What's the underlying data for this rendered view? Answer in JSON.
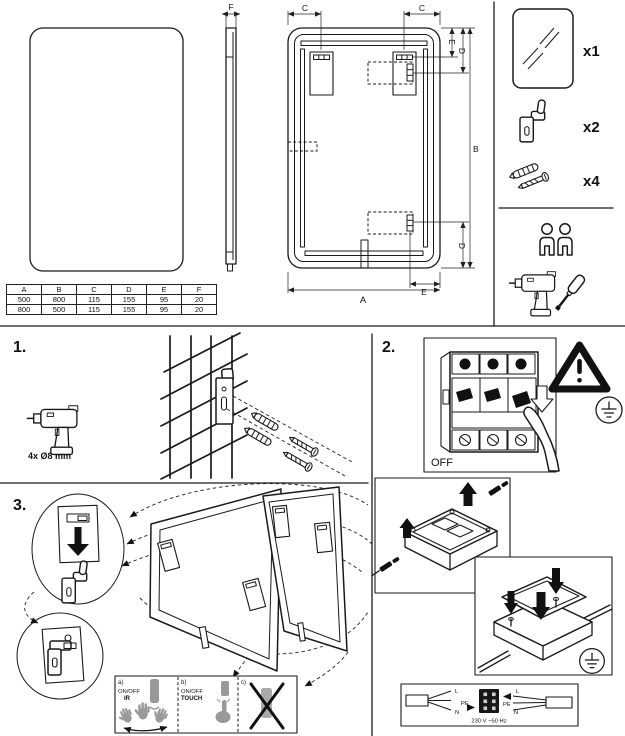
{
  "document": {
    "type": "mirror-installation-manual"
  },
  "colors": {
    "line": "#1a1a1a",
    "dim_line": "#222222",
    "icon_gray": "#999999",
    "background": "#ffffff"
  },
  "dimension_labels": {
    "a": "A",
    "b": "B",
    "c": "C",
    "d": "D",
    "e": "E",
    "f": "F"
  },
  "dimension_table": {
    "headers": [
      "A",
      "B",
      "C",
      "D",
      "E",
      "F"
    ],
    "rows": [
      [
        "500",
        "800",
        "115",
        "155",
        "95",
        "20"
      ],
      [
        "800",
        "500",
        "115",
        "155",
        "95",
        "20"
      ]
    ]
  },
  "parts": {
    "mirror_qty": "x1",
    "bracket_qty": "x2",
    "fastener_qty": "x4"
  },
  "icons": {
    "crew": "two-person-icon",
    "tools": "drill-and-screwdriver-icon",
    "warning": "warning-triangle-icon",
    "earth": "protective-earth-icon"
  },
  "step1": {
    "number": "1.",
    "drill_size_label": "4x Ø8 mm"
  },
  "step2": {
    "number": "2.",
    "breaker_state": "OFF",
    "power_rating": "230 V ~50 Hz",
    "wiring": {
      "left": {
        "l": "L",
        "pe": "PE",
        "n": "N"
      },
      "right": {
        "l": "L",
        "pe": "PE",
        "n": "N"
      }
    }
  },
  "step3": {
    "number": "3.",
    "options": {
      "a": {
        "key": "a)",
        "mode": "ON/OFF",
        "type": "IR"
      },
      "b": {
        "key": "b)",
        "mode": "ON/OFF",
        "type": "TOUCH"
      },
      "c": {
        "key": "c)"
      }
    }
  }
}
